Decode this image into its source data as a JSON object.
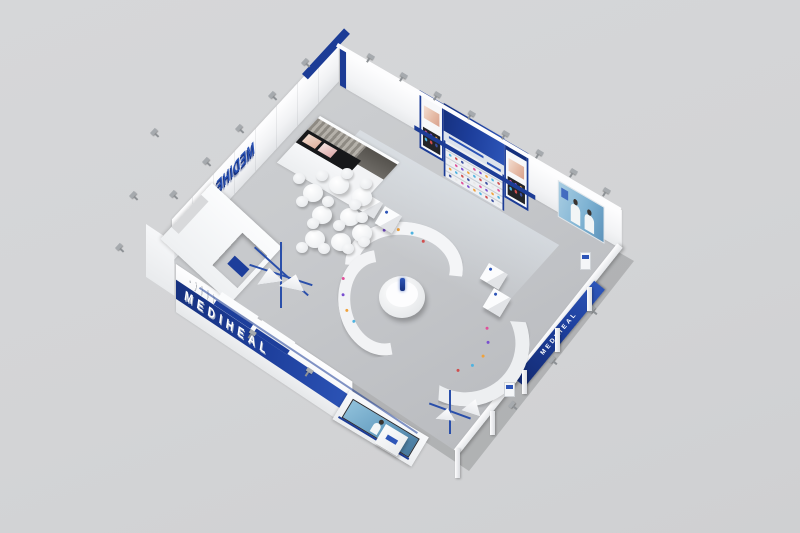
{
  "scene": {
    "type": "3D exhibition booth render, top-down bird's-eye view",
    "setting": "plain light-gray studio background",
    "booth": "rectangular island booth: two solid display walls, two open truss-framed sides"
  },
  "brand": {
    "name": "MEDIHEAL",
    "wall_logo": "MEDIHEAL",
    "side_wall_banner": "MEDIHEAL",
    "outer_rail_banner": "MEDIHEAL"
  },
  "colors": {
    "background": "#d4d5d7",
    "floor": "#c7c9cc",
    "wall_white": "#f4f5f7",
    "brand_navy": "#1c3c96",
    "brand_blue": "#2d55b8",
    "screen_teal": "#7fb3d3"
  },
  "zones": {
    "cafe_area": "round white tables and stools",
    "storage_room": "curtained room with black media band showing model faces",
    "product_wall": "navy header panel over shelves of colorful mask products",
    "display_cabinets": "navy-framed cabinets with model photo and product rows",
    "media_screen": "wall screen showing two models in white",
    "center_display": "round podium with blue product and three curved counters",
    "entrance_portal": "white tunnel entrance with navy counter",
    "led_corner": "corner LED video wall with reception desk",
    "open_frame": "white rail and posts with navy hanging banner"
  }
}
